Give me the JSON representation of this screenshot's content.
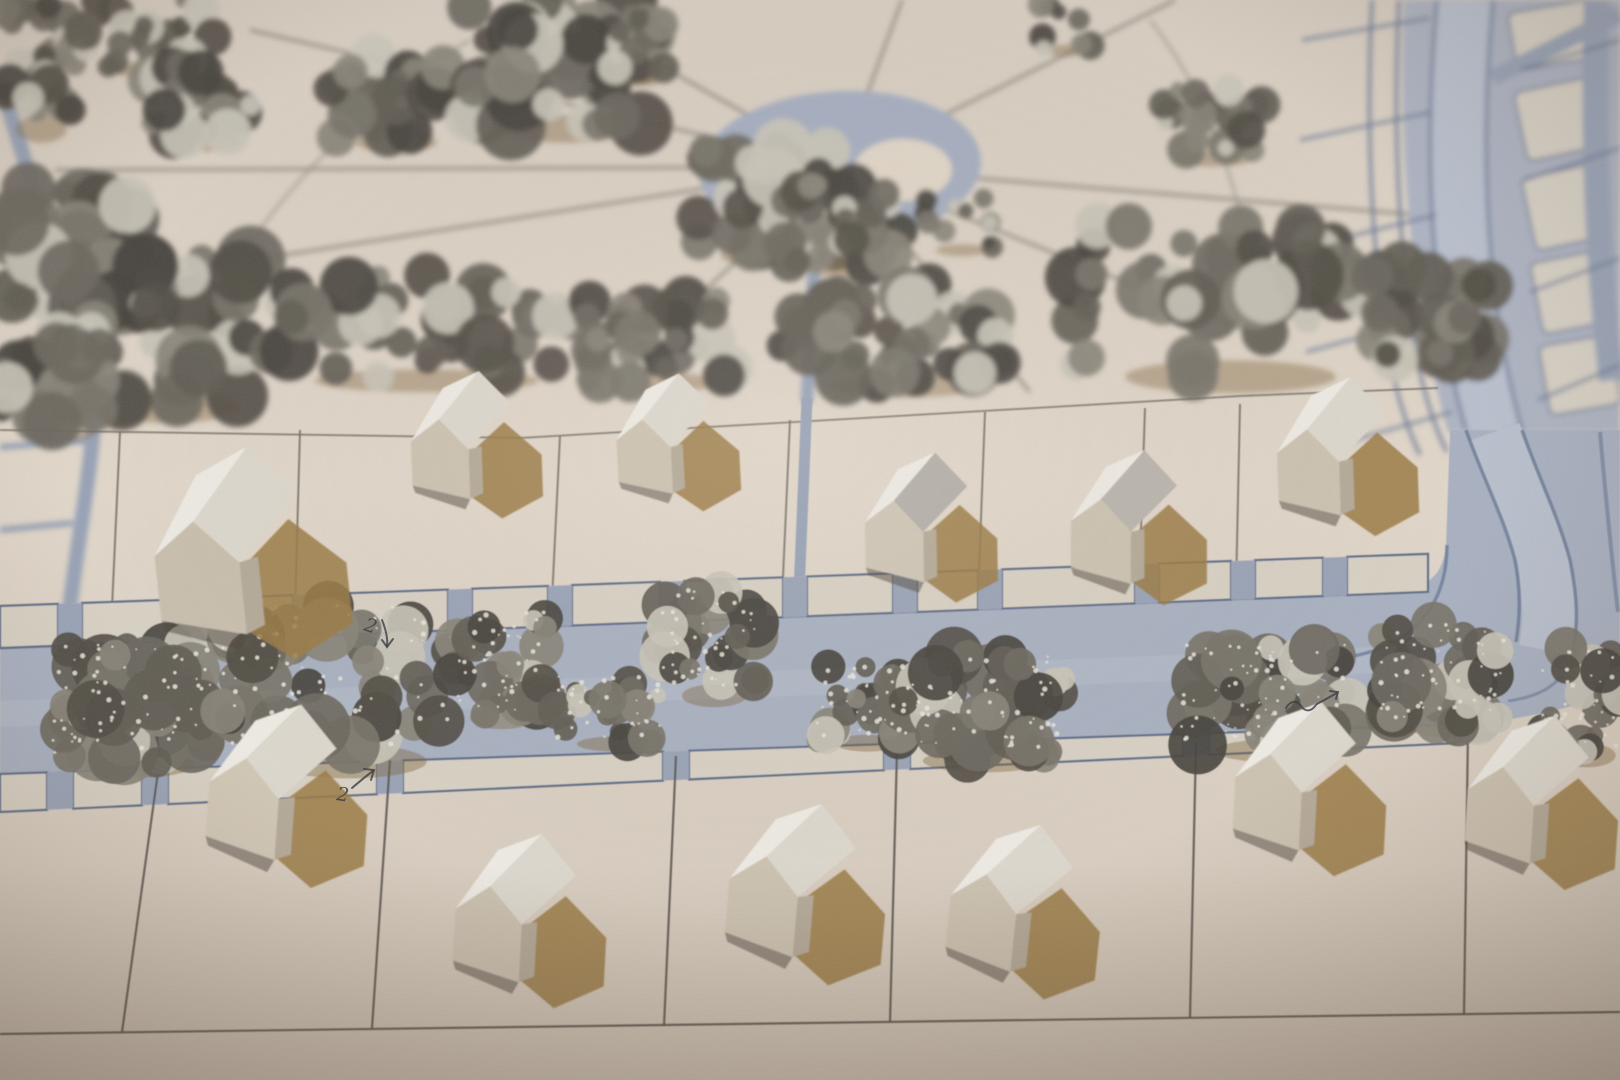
{
  "scene": {
    "kind": "photograph",
    "subject": "cardboard architectural site model, oblique top view",
    "annotations_visible": [
      "2 with down arrow",
      "2 with up-right arrow",
      "squiggle mark"
    ]
  },
  "palette": {
    "bg_top": "#d6ccc0",
    "bg_mid": "#e1d7ca",
    "bg_bot": "#d3c8ba",
    "road": "#a9b1c1",
    "road_light": "#b9c0cd",
    "road_edge": "#6878944d",
    "road_edge_strong": "#687894",
    "sidewalk": "#d8d1c4",
    "sidewalk_line": "#5e6d89",
    "gap_blue": "#9aa4b7",
    "path_blue": "#98a3b6",
    "plaza": "#a6aec0",
    "plaza_island": "#e0d6c8",
    "park_line": "#938e82",
    "pencil": "#6e6960",
    "pencil_dark": "#55514a",
    "roofL": "#eeebe4",
    "roofR": "#ddd8ce",
    "front": "#cdc3b2",
    "side": "#b5ab99",
    "shadow_brown": "#9b7b46",
    "contact": "#4f463b",
    "ink": "#373a42",
    "tree_darks": [
      "#544f48",
      "#635e56",
      "#6e6961",
      "#7a756b",
      "#89847a",
      "#494540"
    ],
    "tree_light": "#c9c4b8",
    "sparkle": "#eae6dc",
    "tree_shadow": "#7d6136"
  },
  "park": {
    "plaza": {
      "cx": 840,
      "cy": 167,
      "rx": 141,
      "ry": 76,
      "rot": -3
    },
    "island": {
      "cx": 903,
      "cy": 170,
      "rx": 49,
      "ry": 31
    },
    "center": [
      840,
      167
    ],
    "ray_ends": [
      [
        545,
        0
      ],
      [
        250,
        30
      ],
      [
        55,
        170
      ],
      [
        0,
        300
      ],
      [
        595,
        390
      ],
      [
        1030,
        392
      ],
      [
        1245,
        330
      ],
      [
        1420,
        215
      ],
      [
        1175,
        0
      ],
      [
        902,
        0
      ]
    ],
    "arcs": [
      "M 470,40 Q 300,140 195,330",
      "M 1150,20 Q 1230,120 1258,300"
    ],
    "wide_path": "M 816,238 C 812,300 810,348 807,398",
    "arc_road": "M 5,95 C 35,200 70,290 92,360 C 102,420 80,520 70,606",
    "arc_branches": [
      "M 0,447 L 86,441",
      "M 0,530 L 73,523"
    ]
  },
  "boulevard": {
    "upper_fill": "M 1404,0 C 1398,150 1410,300 1448,432 L 1620,432 L 1620,0 Z",
    "street_top": "M 1465,0 C 1452,140 1456,300 1494,432",
    "street_bottom": "M 1494,432 C 1510,478 1532,520 1543,562 C 1551,600 1551,624 1546,650",
    "street_edges_top": [
      "M 1437,0 C 1424,140 1428,298 1466,430",
      "M 1493,0 C 1480,140 1484,298 1522,430"
    ],
    "street_edges_bottom": [
      "M 1466,430 C 1482,476 1504,518 1515,560 C 1520,585 1521,612 1516,642",
      "M 1522,430 C 1538,476 1559,518 1570,560 C 1578,600 1578,625 1573,650"
    ],
    "corner_inner": "M 1447,545 C 1447,610 1408,650 1340,658",
    "corner_outer": "M 1573,650 C 1566,682 1544,696 1508,701",
    "right_strip": "M 1597,0 C 1593,130 1597,260 1612,380",
    "right_strip_low": "M 1600,432 C 1606,500 1612,560 1618,612",
    "diag_band": "M 1492,78 L 1620,14",
    "left_strips": [
      "M 1372,0 C 1366,120 1370,250 1390,360 C 1398,400 1408,430 1420,455",
      "M 1399,0 C 1393,120 1397,248 1417,358 C 1425,398 1435,428 1447,452"
    ],
    "cross_left": [
      [
        1302,
        40,
        1430,
        18
      ],
      [
        1300,
        140,
        1432,
        112
      ],
      [
        1302,
        248,
        1436,
        215
      ],
      [
        1306,
        352,
        1442,
        315
      ],
      [
        1318,
        450,
        1452,
        412
      ]
    ],
    "cross_right": [
      [
        1520,
        70,
        1620,
        40
      ],
      [
        1524,
        180,
        1620,
        148
      ],
      [
        1530,
        292,
        1620,
        258
      ],
      [
        1538,
        400,
        1620,
        365
      ]
    ],
    "islands": [
      [
        1512,
        6,
        84,
        58,
        -10
      ],
      [
        1520,
        84,
        80,
        70,
        -12
      ],
      [
        1528,
        170,
        76,
        74,
        -12
      ],
      [
        1536,
        256,
        74,
        72,
        -11
      ],
      [
        1544,
        340,
        72,
        70,
        -10
      ],
      [
        1464,
        452,
        44,
        86,
        -14
      ],
      [
        1470,
        548,
        40,
        70,
        -12
      ]
    ]
  },
  "roads": {
    "main_fill": "M 0,646 L 1380,592 C 1425,588 1440,582 1446,548 L 1450,430 L 1620,430 L 1620,692 C 1556,714 1480,726 1400,734 L 900,752 L 0,776 Z",
    "top_edge": "M 0,648 L 1380,593",
    "bottom_edge": "M 0,775 L 900,750 L 1430,732",
    "lane_band": "M 0,714 L 1380,660",
    "path_down_low": "M 807,398 C 804,480 800,560 797,642"
  },
  "sidewalks": {
    "top": {
      "y0a": 606,
      "sa": -0.0365,
      "y0b": 648,
      "sb": -0.0393,
      "x_end": 1428,
      "gaps": [
        70,
        305,
        460,
        560,
        672,
        795,
        905,
        990,
        1147,
        1243,
        1335
      ],
      "gap_w": 24
    },
    "bottom": {
      "y0a": 774,
      "sa": -0.0338,
      "y0b": 812,
      "sb": -0.0473,
      "x_end": 1485,
      "gaps": [
        60,
        155,
        390,
        676,
        897,
        1196,
        1468
      ],
      "gap_w": 26
    }
  },
  "lots": {
    "back_line": "M 0,430 L 520,438 L 1240,396 L 1438,388",
    "middle": [
      [
        120,
        432,
        112,
        608
      ],
      [
        300,
        430,
        295,
        612
      ],
      [
        560,
        436,
        552,
        600
      ],
      [
        790,
        420,
        782,
        600
      ],
      [
        985,
        412,
        978,
        598
      ],
      [
        1145,
        408,
        1140,
        560
      ],
      [
        1240,
        404,
        1236,
        590
      ]
    ],
    "bottom": [
      [
        158,
        772,
        122,
        1032
      ],
      [
        390,
        760,
        372,
        1028
      ],
      [
        676,
        756,
        664,
        1026
      ],
      [
        897,
        750,
        890,
        1022
      ],
      [
        1196,
        742,
        1190,
        1018
      ],
      [
        1468,
        730,
        1464,
        1014
      ]
    ],
    "base_line": "M 0,1034 L 1620,1012"
  },
  "house_shape": {
    "roofL": [
      [
        8,
        58
      ],
      [
        30,
        42
      ],
      [
        62,
        6
      ],
      [
        34,
        18
      ]
    ],
    "roofR": [
      [
        30,
        42
      ],
      [
        52,
        66
      ],
      [
        86,
        32
      ],
      [
        62,
        6
      ]
    ],
    "front": [
      [
        8,
        58
      ],
      [
        30,
        42
      ],
      [
        52,
        66
      ],
      [
        52,
        104
      ],
      [
        8,
        92
      ]
    ],
    "side": [
      [
        52,
        66
      ],
      [
        52,
        104
      ],
      [
        62,
        100
      ],
      [
        62,
        64
      ]
    ],
    "shadow": [
      [
        52,
        70
      ],
      [
        80,
        46
      ],
      [
        108,
        72
      ],
      [
        108,
        104
      ],
      [
        76,
        120
      ],
      [
        52,
        102
      ]
    ],
    "contact": [
      [
        8,
        92
      ],
      [
        52,
        104
      ],
      [
        48,
        112
      ],
      [
        10,
        98
      ]
    ]
  },
  "houses": [
    {
      "id": "m1",
      "row": "mid",
      "x": 128,
      "y": 448,
      "s": 1.9,
      "rot": -6,
      "front": "#c9bfae"
    },
    {
      "id": "m2",
      "row": "mid",
      "x": 398,
      "y": 366,
      "s": 1.3,
      "rot": -2
    },
    {
      "id": "m3",
      "row": "mid",
      "x": 603,
      "y": 370,
      "s": 1.22,
      "rot": -3
    },
    {
      "id": "m4",
      "row": "mid",
      "x": 853,
      "y": 446,
      "s": 1.32,
      "rot": -1,
      "roofR": "#b4b0a9",
      "front": "#cfc6b6"
    },
    {
      "id": "m5",
      "row": "mid",
      "x": 1060,
      "y": 442,
      "s": 1.36,
      "rot": 0,
      "roofR": "#bab5ad"
    },
    {
      "id": "m6",
      "row": "mid",
      "x": 1263,
      "y": 372,
      "s": 1.4,
      "rot": -2
    },
    {
      "id": "b1",
      "row": "bottom",
      "x": 203,
      "y": 688,
      "s": 1.6,
      "rot": 4,
      "front": "#d2c8b7"
    },
    {
      "id": "b2",
      "row": "bottom",
      "x": 448,
      "y": 820,
      "s": 1.52,
      "rot": 3
    },
    {
      "id": "b3",
      "row": "bottom",
      "x": 725,
      "y": 786,
      "s": 1.58,
      "rot": 5
    },
    {
      "id": "b4",
      "row": "bottom",
      "x": 948,
      "y": 806,
      "s": 1.52,
      "rot": 6
    },
    {
      "id": "b5",
      "row": "bottom",
      "x": 1228,
      "y": 688,
      "s": 1.52,
      "rot": 3
    },
    {
      "id": "b6",
      "row": "bottom",
      "x": 1462,
      "y": 700,
      "s": 1.52,
      "rot": 4
    }
  ],
  "trees": [
    {
      "x": 0,
      "y": 0,
      "w": 75,
      "h": 140,
      "g": "park",
      "seed": 11,
      "sp": 0
    },
    {
      "x": 70,
      "y": 0,
      "w": 150,
      "h": 75,
      "g": "park",
      "seed": 12,
      "sp": 0
    },
    {
      "x": 145,
      "y": 55,
      "w": 110,
      "h": 95,
      "g": "park",
      "seed": 13,
      "sp": 0
    },
    {
      "x": 330,
      "y": 50,
      "w": 120,
      "h": 100,
      "g": "park",
      "seed": 14,
      "sp": 0
    },
    {
      "x": 465,
      "y": 0,
      "w": 185,
      "h": 140,
      "g": "park",
      "seed": 15,
      "sp": 0
    },
    {
      "x": 600,
      "y": 15,
      "w": 70,
      "h": 70,
      "g": "park",
      "seed": 16,
      "sp": 0
    },
    {
      "x": 690,
      "y": 145,
      "w": 145,
      "h": 120,
      "g": "park",
      "seed": 17,
      "sp": 0
    },
    {
      "x": 775,
      "y": 180,
      "w": 125,
      "h": 95,
      "g": "park",
      "seed": 18,
      "sp": 0
    },
    {
      "x": 920,
      "y": 195,
      "w": 75,
      "h": 60,
      "g": "park",
      "seed": 19,
      "sp": 0
    },
    {
      "x": 1030,
      "y": 0,
      "w": 65,
      "h": 55,
      "g": "park",
      "seed": 20,
      "sp": 0
    },
    {
      "x": 1150,
      "y": 90,
      "w": 115,
      "h": 75,
      "g": "park",
      "seed": 21,
      "sp": 0
    },
    {
      "x": 1060,
      "y": 225,
      "w": 310,
      "h": 165,
      "g": "park",
      "seed": 22,
      "sp": 0
    },
    {
      "x": 1370,
      "y": 265,
      "w": 120,
      "h": 105,
      "g": "park",
      "seed": 23,
      "sp": 0
    },
    {
      "x": 0,
      "y": 185,
      "w": 130,
      "h": 130,
      "g": "park",
      "seed": 24,
      "sp": 0
    },
    {
      "x": 60,
      "y": 255,
      "w": 200,
      "h": 165,
      "g": "park",
      "seed": 25,
      "sp": 0
    },
    {
      "x": 0,
      "y": 320,
      "w": 110,
      "h": 120,
      "g": "park",
      "seed": 26,
      "sp": 0
    },
    {
      "x": 245,
      "y": 275,
      "w": 330,
      "h": 115,
      "g": "park",
      "seed": 27,
      "sp": 0
    },
    {
      "x": 545,
      "y": 295,
      "w": 200,
      "h": 95,
      "g": "park",
      "seed": 28,
      "sp": 0
    },
    {
      "x": 780,
      "y": 285,
      "w": 230,
      "h": 110,
      "g": "park",
      "seed": 29,
      "sp": 0
    },
    {
      "x": 52,
      "y": 645,
      "w": 160,
      "h": 130,
      "g": "road",
      "seed": 31,
      "sp": 1
    },
    {
      "x": 222,
      "y": 605,
      "w": 230,
      "h": 170,
      "g": "road",
      "seed": 32,
      "sp": 1
    },
    {
      "x": 450,
      "y": 612,
      "w": 95,
      "h": 115,
      "g": "road",
      "seed": 33,
      "sp": 1
    },
    {
      "x": 555,
      "y": 675,
      "w": 105,
      "h": 75,
      "g": "road",
      "seed": 34,
      "sp": 1
    },
    {
      "x": 662,
      "y": 590,
      "w": 95,
      "h": 115,
      "g": "road",
      "seed": 35,
      "sp": 1
    },
    {
      "x": 815,
      "y": 665,
      "w": 95,
      "h": 85,
      "g": "road",
      "seed": 36,
      "sp": 1
    },
    {
      "x": 885,
      "y": 655,
      "w": 180,
      "h": 115,
      "g": "road",
      "seed": 37,
      "sp": 1
    },
    {
      "x": 1180,
      "y": 645,
      "w": 170,
      "h": 115,
      "g": "road",
      "seed": 38,
      "sp": 1
    },
    {
      "x": 1380,
      "y": 620,
      "w": 125,
      "h": 115,
      "g": "road",
      "seed": 39,
      "sp": 1
    },
    {
      "x": 1540,
      "y": 645,
      "w": 85,
      "h": 120,
      "g": "road",
      "seed": 40,
      "sp": 1
    }
  ],
  "annotations": [
    {
      "text": "2",
      "x": 363,
      "y": 630,
      "rot": 18,
      "fs": 19,
      "paths": [
        "M 382,620 C 386,630 388,638 387,646",
        "M 382,640 L 387,647 L 393,639"
      ]
    },
    {
      "text": "2",
      "x": 336,
      "y": 800,
      "rot": 8,
      "fs": 19,
      "paths": [
        "M 352,788 C 359,782 366,776 373,771",
        "M 364,769 L 374,770 L 371,780"
      ]
    },
    {
      "text": "",
      "x": 1286,
      "y": 708,
      "rot": 0,
      "fs": 0,
      "paths": [
        "M 1286,708 C 1291,700 1297,700 1301,706 C 1305,712 1311,712 1316,705",
        "M 1317,704 L 1337,693",
        "M 1330,691 L 1338,692 L 1336,699"
      ]
    }
  ],
  "effects": {
    "blur_park": 2.6,
    "blur_mid": 0.45,
    "blur_houses_mid": 0.8,
    "blur_bottom": 0.9,
    "grain_slope": 0.13,
    "vignette_edge": "rgba(62,48,36,0.30)",
    "vignette_center": "rgba(255,248,238,0.10)"
  }
}
